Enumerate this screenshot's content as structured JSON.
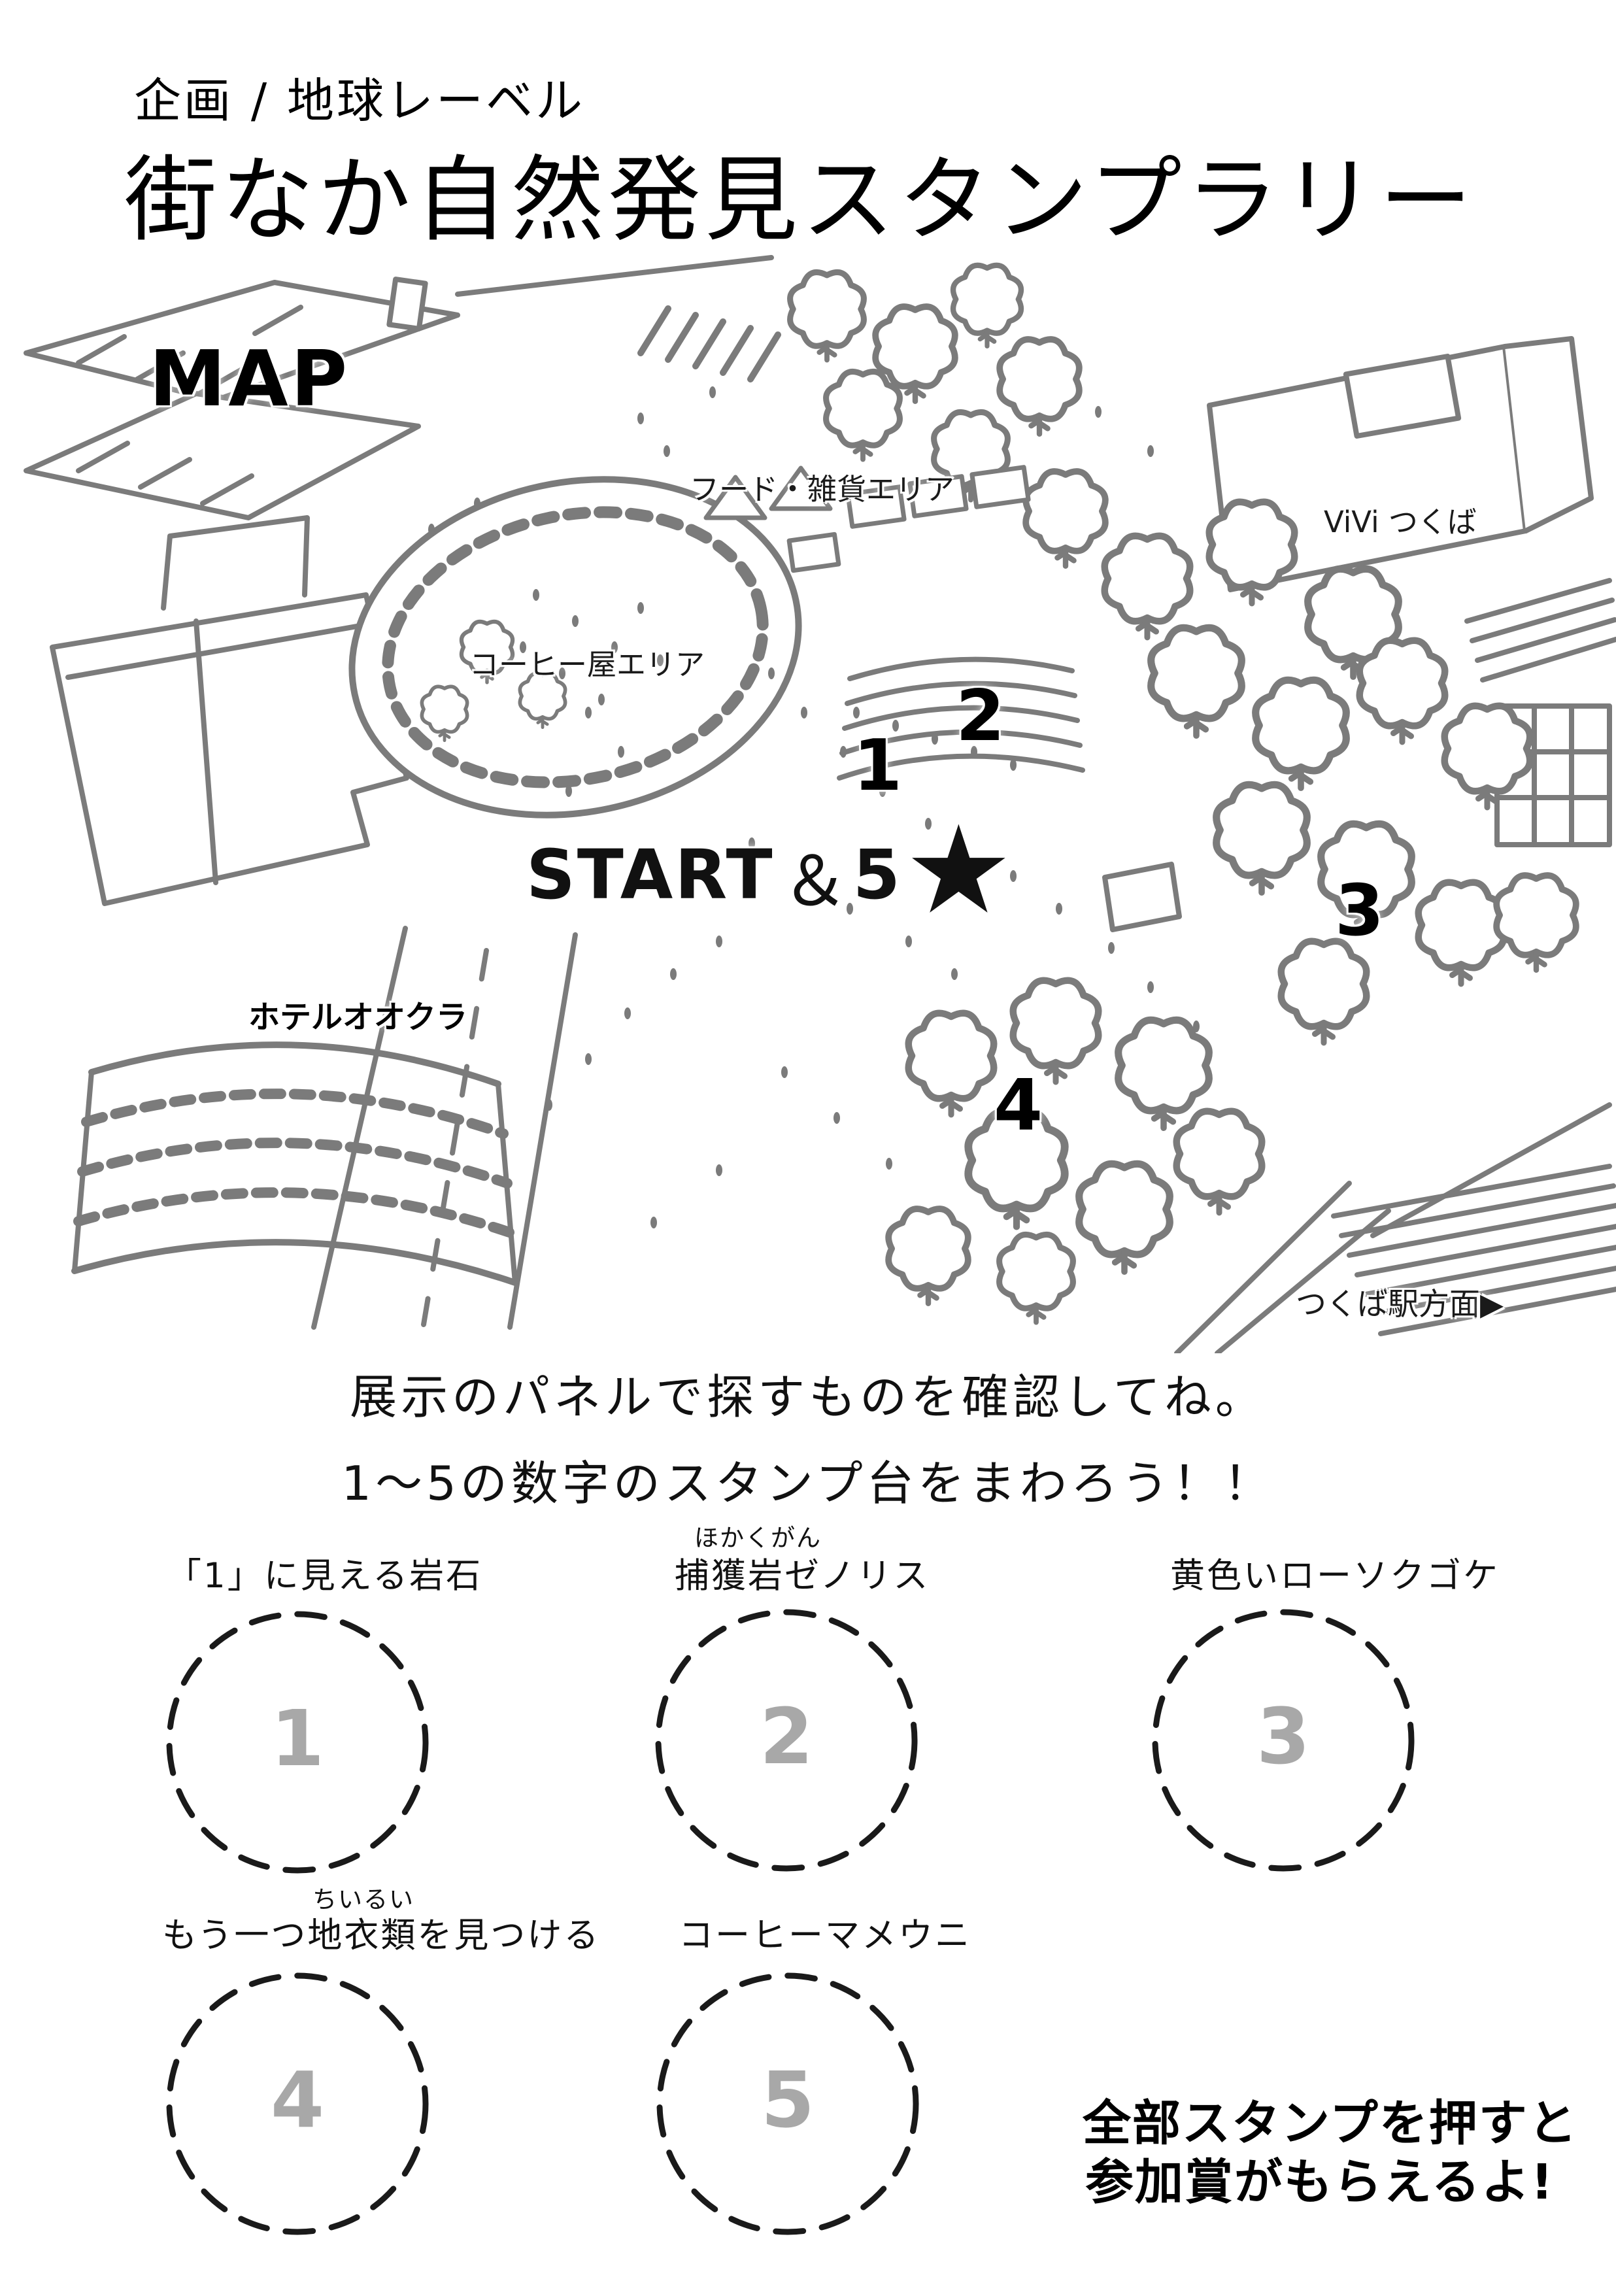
{
  "header": {
    "organizer": "企画 / 地球レーベル",
    "title": "街なか自然発見スタンプラリー"
  },
  "map": {
    "map_label": "MAP",
    "area_food": "フード・雑貨エリア",
    "area_vivi": "ViVi つくば",
    "area_coffee": "コーヒー屋エリア",
    "area_hotel": "ホテルオオクラ",
    "area_station": "つくば駅方面",
    "station_arrow": "▶",
    "marker1": "1",
    "marker2": "2",
    "marker3": "3",
    "marker4": "4",
    "start_text": "START",
    "start_amp": "＆",
    "start_five": "5",
    "start_star": "★"
  },
  "instructions": {
    "line1": "展示のパネルで探すものを確認してね。",
    "line2": "1〜5の数字のスタンプ台をまわろう！！"
  },
  "stamps": [
    {
      "number": "1",
      "furigana": "",
      "label": "「1」に見える岩石"
    },
    {
      "number": "2",
      "furigana": "ほかくがん",
      "label": "捕獲岩ゼノリス"
    },
    {
      "number": "3",
      "furigana": "",
      "label": "黄色いローソクゴケ"
    },
    {
      "number": "4",
      "furigana": "ちいるい",
      "label": "もう一つ地衣類を見つける"
    },
    {
      "number": "5",
      "furigana": "",
      "label": "コーヒーマメウニ"
    }
  ],
  "reward": {
    "line1": "全部スタンプを押すと",
    "line2": "参加賞がもらえるよ!"
  },
  "colors": {
    "sketch": "#7b7b7b",
    "ink": "#111111",
    "stamp_number_gray": "#a8a8a8"
  }
}
